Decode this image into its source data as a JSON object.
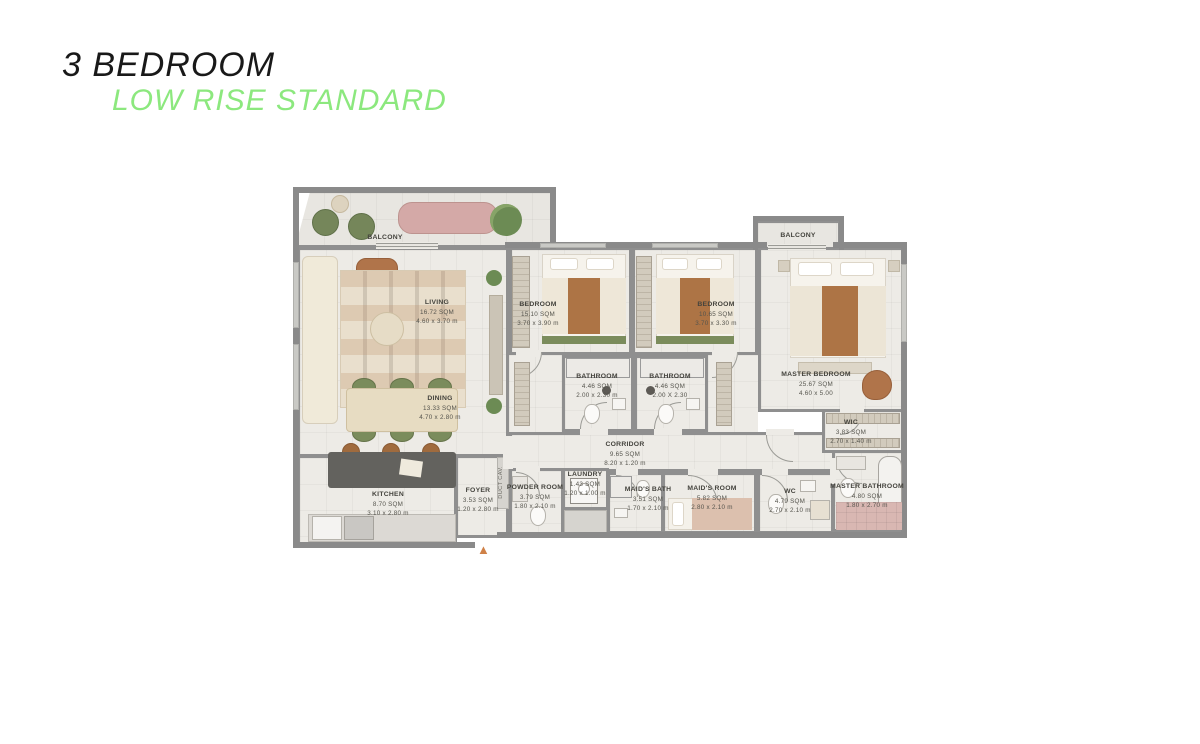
{
  "title": {
    "heading": "3 BEDROOM",
    "subheading": "LOW RISE STANDARD"
  },
  "colors": {
    "subheading_green": "#8CE87E",
    "wall_gray": "#8A8A8A",
    "floor": "#EDEBE6",
    "entrance_arrow": "#CF8147"
  },
  "plan": {
    "entrance_icon": "▲",
    "duct_label": "DUCT CAV."
  },
  "rooms": {
    "balcony_left": {
      "name": "BALCONY"
    },
    "balcony_right": {
      "name": "BALCONY"
    },
    "living": {
      "name": "LIVING",
      "area": "16.72 SQM",
      "dims": "4.60 x 3.70 m"
    },
    "dining": {
      "name": "DINING",
      "area": "13.33 SQM",
      "dims": "4.70 x 2.80 m"
    },
    "kitchen": {
      "name": "KITCHEN",
      "area": "8.70 SQM",
      "dims": "3.10 x 2.80 m"
    },
    "bedroom_1": {
      "name": "BEDROOM",
      "area": "15.10 SQM",
      "dims": "3.70 x 3.90 m"
    },
    "bedroom_2": {
      "name": "BEDROOM",
      "area": "10.65 SQM",
      "dims": "3.70 x 3.30 m"
    },
    "master_bedroom": {
      "name": "MASTER BEDROOM",
      "area": "25.67 SQM",
      "dims": "4.60 x 5.00"
    },
    "bathroom_1": {
      "name": "BATHROOM",
      "area": "4.46 SQM",
      "dims": "2.00 x 2.30 m"
    },
    "bathroom_2": {
      "name": "BATHROOM",
      "area": "4.46 SQM",
      "dims": "2.00 X 2.30"
    },
    "wic": {
      "name": "WIC",
      "area": "3.83 SQM",
      "dims": "2.70 x 1.40 m"
    },
    "master_bathroom": {
      "name": "MASTER BATHROOM",
      "area": "4.80 SQM",
      "dims": "1.80 x 2.70 m"
    },
    "wc": {
      "name": "WC",
      "area": "4.79 SQM",
      "dims": "2.70 x 2.10 m"
    },
    "maids_room": {
      "name": "MAID'S ROOM",
      "area": "5.82 SQM",
      "dims": "2.80 x 2.10 m"
    },
    "maids_bath": {
      "name": "MAID'S BATH",
      "area": "3.51 SQM",
      "dims": "1.70 x 2.10 m"
    },
    "corridor": {
      "name": "CORRIDOR",
      "area": "9.65 SQM",
      "dims": "8.20 x 1.20 m"
    },
    "laundry": {
      "name": "LAUNDRY",
      "area": "1.43 SQM",
      "dims": "1.20 x 1.00 m"
    },
    "powder_room": {
      "name": "POWDER ROOM",
      "area": "3.79 SQM",
      "dims": "1.80 x 2.10 m"
    },
    "foyer": {
      "name": "FOYER",
      "area": "3.53 SQM",
      "dims": "1.20 x 2.80 m"
    }
  }
}
